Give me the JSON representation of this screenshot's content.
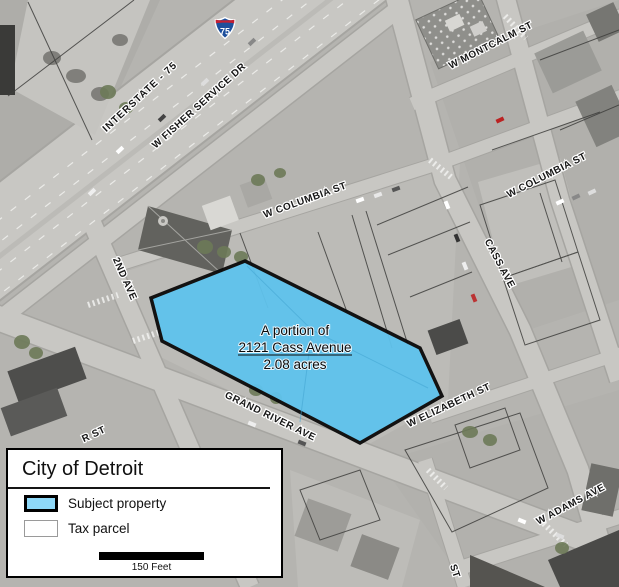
{
  "map": {
    "highway_shield": "75",
    "street_labels": {
      "interstate": "INTERSTATE - 75",
      "fisher": "W FISHER SERVICE DR",
      "montcalm": "W MONTCALM ST",
      "columbia_left": "W COLUMBIA ST",
      "columbia_right": "W COLUMBIA ST",
      "cass": "CASS AVE",
      "second": "2ND AVE",
      "grand_river": "GRAND RIVER AVE",
      "elizabeth": "W ELIZABETH ST",
      "adams": "W ADAMS AVE",
      "partial_r": "R ST",
      "partial_st": "ST"
    },
    "subject_label": {
      "line1": "A portion of",
      "line2": "2121 Cass Avenue",
      "line3": "2.08 acres"
    },
    "colors": {
      "subject_fill": "#5fc3ed",
      "subject_border": "#0a0a0a",
      "legend_swatch": "#8ed8f8"
    }
  },
  "legend": {
    "title": "City of Detroit",
    "items": [
      {
        "label": "Subject property"
      },
      {
        "label": "Tax parcel"
      }
    ],
    "scale_text": "150 Feet"
  }
}
